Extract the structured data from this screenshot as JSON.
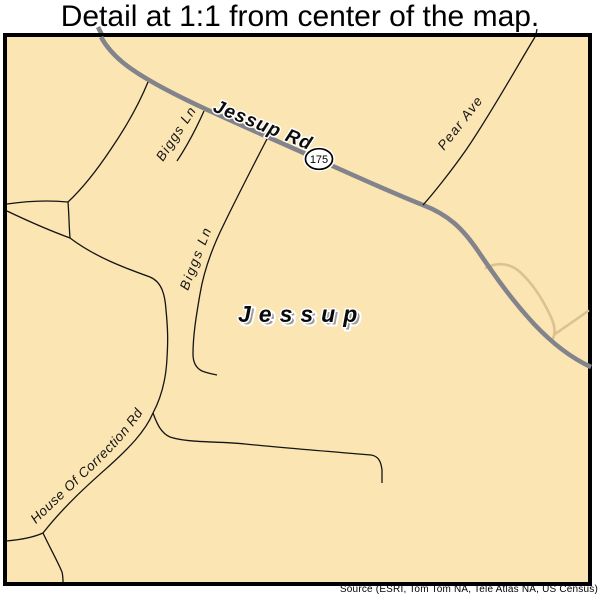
{
  "header": {
    "title": "Detail at 1:1 from center of the map."
  },
  "map": {
    "city_label": "Jessup",
    "roads": {
      "jessup_rd": "Jessup Rd",
      "pear_ave": "Pear Ave",
      "biggs_ln_upper": "Biggs Ln",
      "biggs_ln_lower": "Biggs Ln",
      "house_of_correction_rd": "House Of Correction Rd"
    },
    "route_shield": {
      "number": "175"
    },
    "colors": {
      "background": "#FBE5B3",
      "major_road": "#83838C",
      "minor_road": "#141414",
      "local_road": "#DCC290",
      "border": "#000000",
      "city_shadow": "#9b9b9b"
    }
  },
  "footer": {
    "source": "Source (ESRI, Tom Tom NA, Tele Atlas NA, US Census)"
  }
}
